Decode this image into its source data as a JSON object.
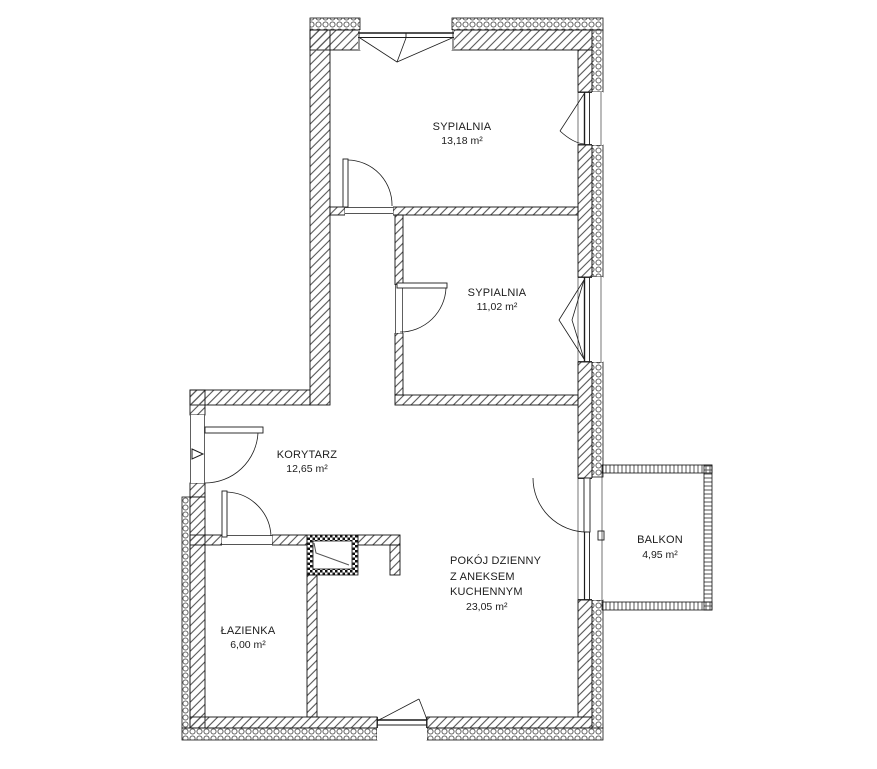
{
  "plan": {
    "type": "apartment-floor-plan",
    "language": "pl",
    "colors": {
      "background": "#ffffff",
      "line": "#1c1c1c",
      "hatch": "#555555"
    },
    "icons": {
      "entrance_marker": "triangle-right"
    }
  },
  "rooms": [
    {
      "id": "sypialnia-1",
      "name": "SYPIALNIA",
      "area": "13,18 m²"
    },
    {
      "id": "sypialnia-2",
      "name": "SYPIALNIA",
      "area": "11,02 m²"
    },
    {
      "id": "korytarz",
      "name": "KORYTARZ",
      "area": "12,65 m²"
    },
    {
      "id": "pokoj-dzienny",
      "name_lines": [
        "POKÓJ DZIENNY",
        "Z ANEKSEM",
        "KUCHENNYM"
      ],
      "area": "23,05 m²"
    },
    {
      "id": "lazienka",
      "name": "ŁAZIENKA",
      "area": "6,00 m²"
    },
    {
      "id": "balkon",
      "name": "BALKON",
      "area": "4,95 m²"
    }
  ]
}
